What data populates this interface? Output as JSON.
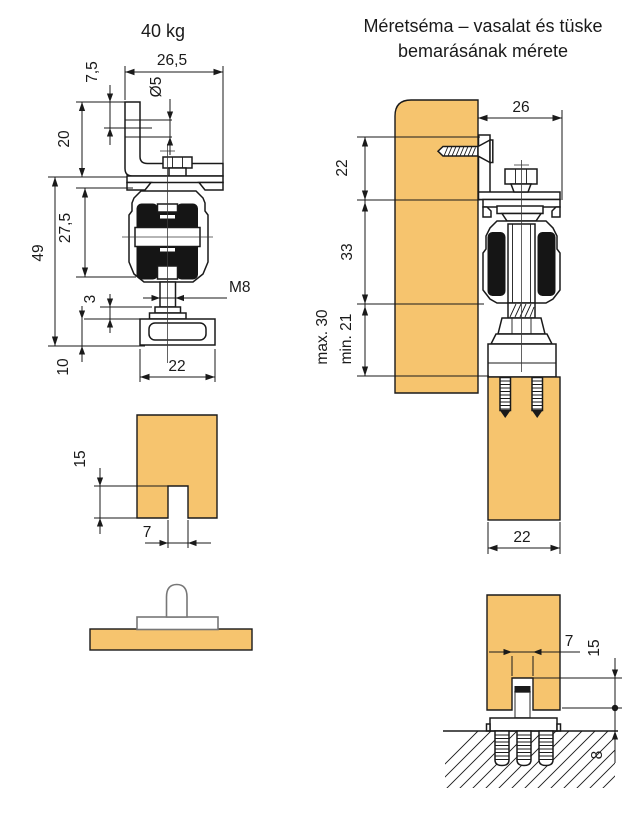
{
  "colors": {
    "wood": "#F6C46E",
    "outline": "#1A1A1A",
    "roller": "#151515",
    "guide_gray": "#777777",
    "background": "#FFFFFF"
  },
  "titles": {
    "left_figure": "40 kg",
    "right_figure_line1": "Méretséma – vasalat és tüske",
    "right_figure_line2": "bemarásának mérete"
  },
  "figures": {
    "hanger_front_view": {
      "dims": {
        "top_width": "26,5",
        "hole_offset": "7,5",
        "hole_diameter": "Ø5",
        "bracket_height": "20",
        "housing_height": "27,5",
        "overall_height": "49",
        "washer_thickness": "3",
        "plate_height": "10",
        "plate_width": "22",
        "thread_label": "M8"
      }
    },
    "hanger_side_view": {
      "dims": {
        "rail_depth": "26",
        "bracket_offset": "22",
        "housing_drop": "33",
        "max_adjust": "max. 30",
        "min_adjust": "min. 21",
        "door_thickness": "22"
      }
    },
    "door_groove_front": {
      "dims": {
        "groove_depth": "15",
        "groove_width": "7"
      }
    },
    "floor_guide_section": {
      "dims": {
        "groove_width": "7",
        "groove_depth": "15",
        "floor_gap": "8"
      }
    }
  }
}
